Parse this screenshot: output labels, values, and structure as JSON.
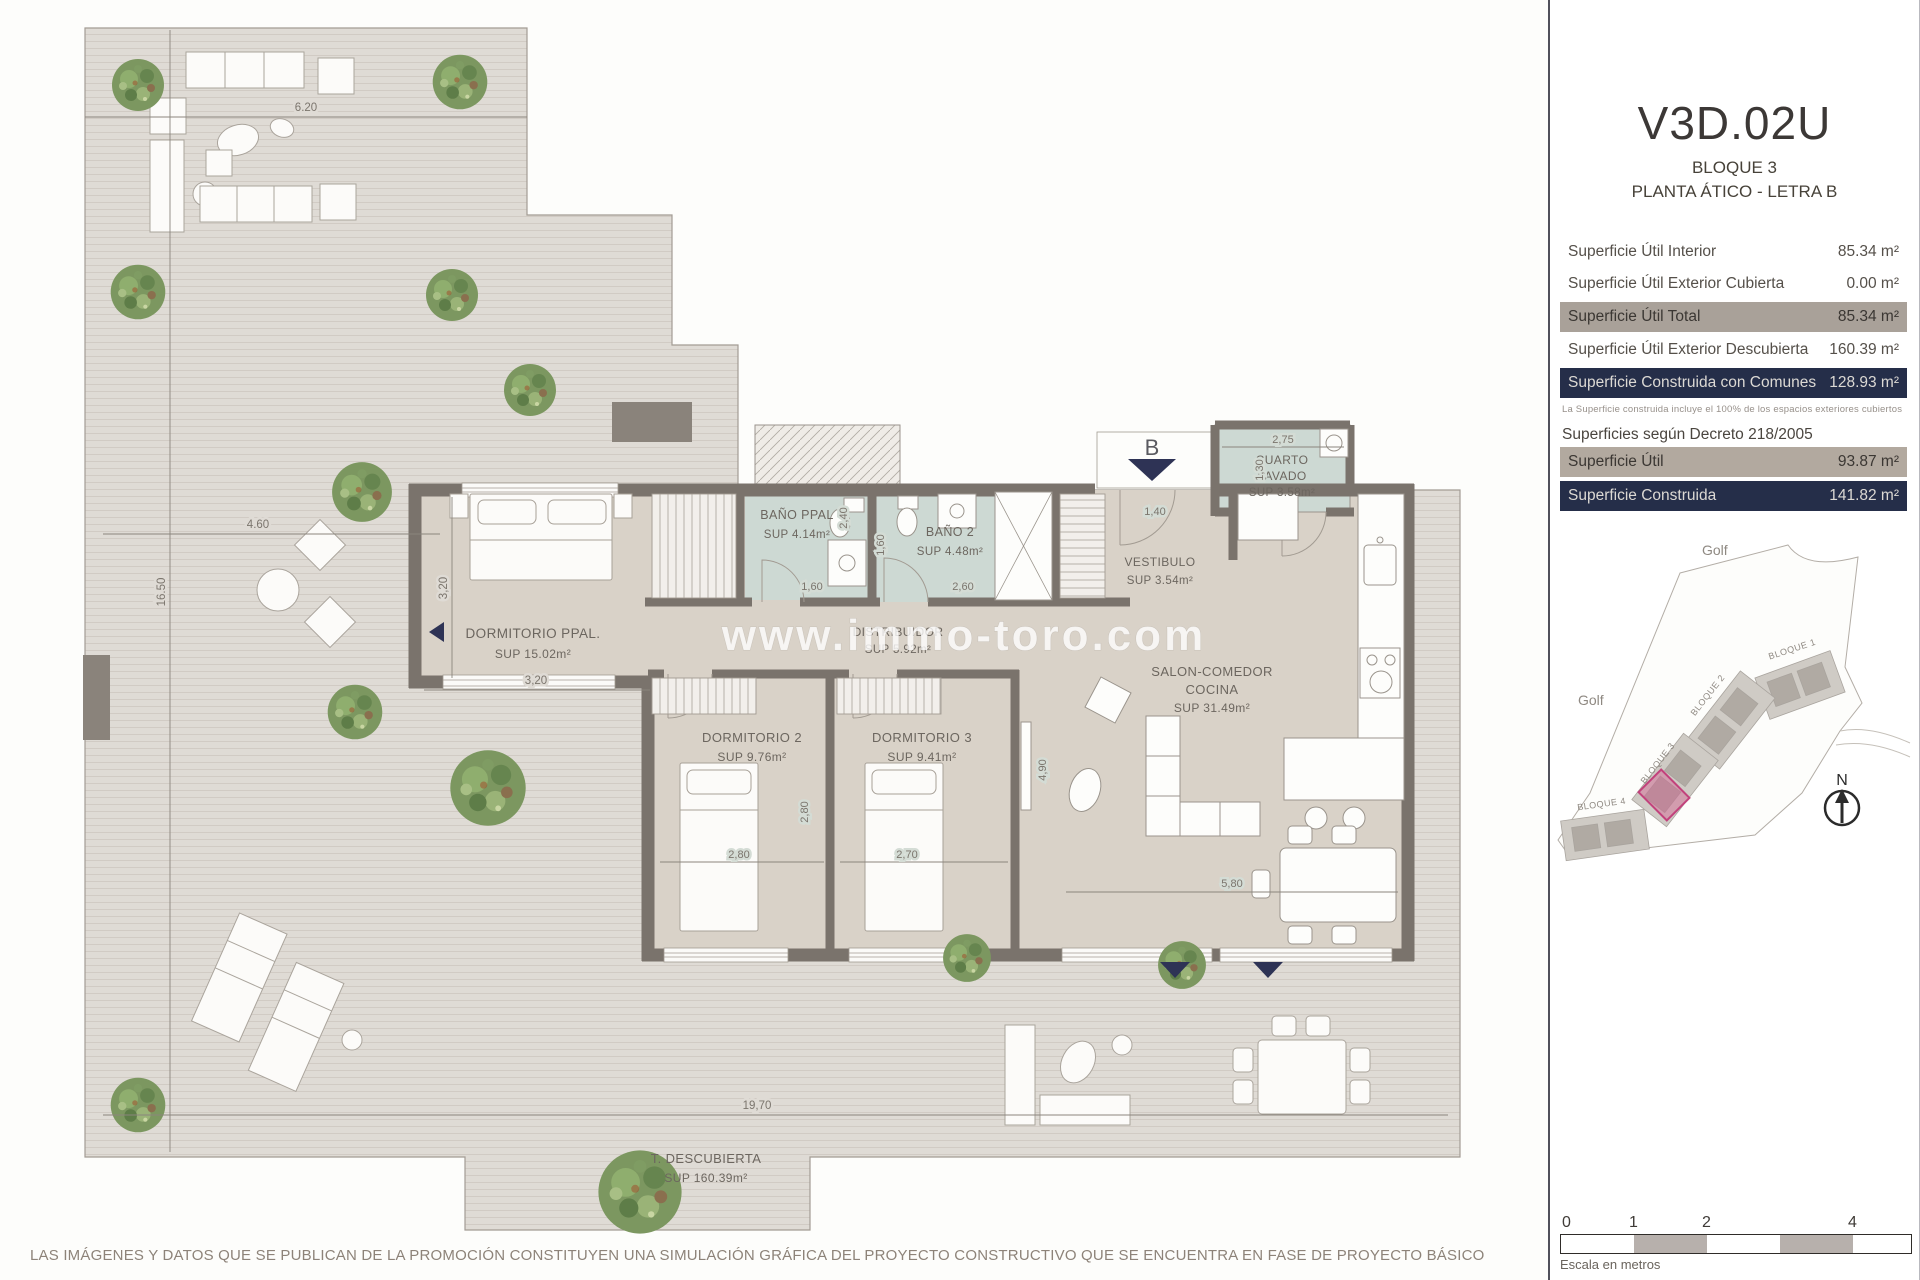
{
  "colors": {
    "accent_navy": "#252e49",
    "row_gray": "#a9a199",
    "highlight_pink": "#c2427c",
    "bath_floor": "#cdd9d3",
    "interior_floor": "#d9d2c8"
  },
  "panel": {
    "unit_code": "V3D.02U",
    "block": "BLOQUE 3",
    "floor": "PLANTA ÁTICO - LETRA B",
    "rows": [
      {
        "label": "Superficie Útil Interior",
        "value": "85.34 m²"
      },
      {
        "label": "Superficie Útil Exterior Cubierta",
        "value": "0.00 m²"
      },
      {
        "label": "Superficie Útil Total",
        "value": "85.34 m²"
      },
      {
        "label": "Superficie Útil Exterior Descubierta",
        "value": "160.39 m²"
      },
      {
        "label": "Superficie Construida con Comunes",
        "value": "128.93 m²"
      }
    ],
    "note": "La Superficie construida incluye el 100% de los espacios exteriores cubiertos",
    "decree_heading": "Superficies según Decreto 218/2005",
    "decree_rows": [
      {
        "label": "Superficie Útil",
        "value": "93.87 m²"
      },
      {
        "label": "Superficie Construida",
        "value": "141.82 m²"
      }
    ],
    "site_plan": {
      "golf_top": "Golf",
      "golf_left": "Golf",
      "blocks": [
        "BLOQUE 1",
        "BLOQUE 2",
        "BLOQUE 3",
        "BLOQUE 4"
      ],
      "compass": "N"
    },
    "scale": {
      "ticks": [
        "0",
        "1",
        "2",
        "4"
      ],
      "caption": "Escala en metros"
    }
  },
  "plan": {
    "watermark": "www.immo-toro.com",
    "entrance_label": "B",
    "rooms": {
      "dormitorio_ppal": {
        "name": "DORMITORIO PPAL.",
        "sup": "SUP 15.02m²"
      },
      "bano_ppal": {
        "name": "BAÑO PPAL",
        "sup": "SUP 4.14m²"
      },
      "bano_2": {
        "name": "BAÑO 2",
        "sup": "SUP 4.48m²"
      },
      "distribuidor": {
        "name": "DISTRIBUIDOR",
        "sup": "SUP 5.92m²"
      },
      "vestibulo": {
        "name": "VESTIBULO",
        "sup": "SUP 3.54m²"
      },
      "cuarto_lavado": {
        "name1": "CUARTO",
        "name2": "LAVADO",
        "sup": "SUP 3.58m²"
      },
      "salon": {
        "name1": "SALON-COMEDOR",
        "name2": "COCINA",
        "sup": "SUP 31.49m²"
      },
      "dormitorio_2": {
        "name": "DORMITORIO 2",
        "sup": "SUP 9.76m²"
      },
      "dormitorio_3": {
        "name": "DORMITORIO 3",
        "sup": "SUP 9.41m²"
      },
      "terraza": {
        "name": "T. DESCUBIERTA",
        "sup": "SUP 160.39m²"
      }
    },
    "dims": {
      "top": "6.20",
      "left_h": "4.60",
      "left_v": "16.50",
      "bottom": "19,70",
      "m320h": "3,20",
      "m320v": "3,20",
      "m160": "1,60",
      "m240": "2,40",
      "m160v": "1,60",
      "m260": "2,60",
      "m140": "1,40",
      "m275": "2,75",
      "m130": "1,30",
      "m280v": "2,80",
      "m280h": "2,80",
      "m270": "2,70",
      "m490": "4,90",
      "m580": "5,80"
    }
  },
  "footer": {
    "disclaimer": "LAS IMÁGENES Y DATOS QUE SE PUBLICAN DE LA PROMOCIÓN CONSTITUYEN UNA SIMULACIÓN GRÁFICA DEL PROYECTO CONSTRUCTIVO QUE SE ENCUENTRA EN FASE DE PROYECTO BÁSICO"
  }
}
